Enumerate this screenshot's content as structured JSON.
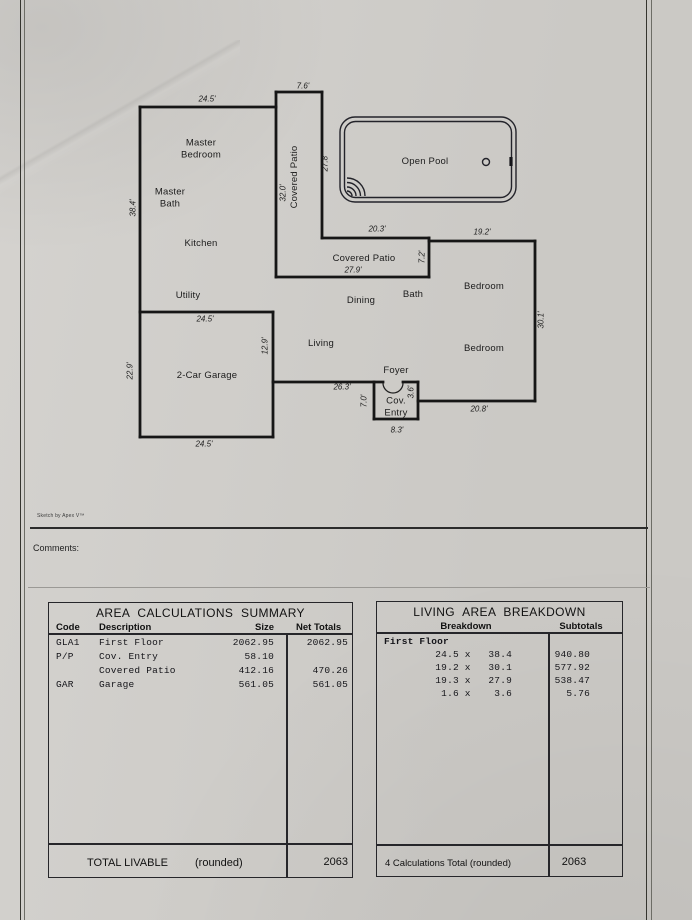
{
  "page": {
    "paper_color": "#d2d0cc",
    "ink_color": "#1c1c1c"
  },
  "footer": {
    "sketch_credit": "Sketch by Apex V™",
    "comments_label": "Comments:"
  },
  "plan": {
    "rooms": [
      {
        "id": "master-bedroom",
        "text": "Master\nBedroom"
      },
      {
        "id": "master-bath",
        "text": "Master\nBath"
      },
      {
        "id": "kitchen",
        "text": "Kitchen"
      },
      {
        "id": "utility",
        "text": "Utility"
      },
      {
        "id": "garage",
        "text": "2-Car Garage"
      },
      {
        "id": "covered-patio-vertical",
        "text": "Covered Patio"
      },
      {
        "id": "open-pool",
        "text": "Open Pool"
      },
      {
        "id": "covered-patio",
        "text": "Covered Patio"
      },
      {
        "id": "dining",
        "text": "Dining"
      },
      {
        "id": "bath",
        "text": "Bath"
      },
      {
        "id": "bedroom-north",
        "text": "Bedroom"
      },
      {
        "id": "bedroom-south",
        "text": "Bedroom"
      },
      {
        "id": "living",
        "text": "Living"
      },
      {
        "id": "foyer",
        "text": "Foyer"
      },
      {
        "id": "cov-entry",
        "text": "Cov.\nEntry"
      }
    ],
    "dimensions": [
      {
        "text": "24.5'"
      },
      {
        "text": "7.6'"
      },
      {
        "text": "38.4'"
      },
      {
        "text": "32.0'"
      },
      {
        "text": "27.8'"
      },
      {
        "text": "20.3'"
      },
      {
        "text": "19.2'"
      },
      {
        "text": "27.9'"
      },
      {
        "text": "7.2'"
      },
      {
        "text": "30.1'"
      },
      {
        "text": "22.9'"
      },
      {
        "text": "24.5'"
      },
      {
        "text": "12.9'"
      },
      {
        "text": "24.5'"
      },
      {
        "text": "26.3'"
      },
      {
        "text": "7.0'"
      },
      {
        "text": "3.6'"
      },
      {
        "text": "8.3'"
      },
      {
        "text": "20.8'"
      }
    ]
  },
  "area_summary": {
    "title": "AREA CALCULATIONS SUMMARY",
    "headers": {
      "code": "Code",
      "description": "Description",
      "size": "Size",
      "net": "Net Totals"
    },
    "rows": [
      {
        "code": "GLA1",
        "description": "First Floor",
        "size": "2062.95",
        "net": "2062.95"
      },
      {
        "code": "P/P",
        "description": "Cov. Entry",
        "size": "58.10",
        "net": ""
      },
      {
        "code": "",
        "description": "Covered Patio",
        "size": "412.16",
        "net": "470.26"
      },
      {
        "code": "GAR",
        "description": "Garage",
        "size": "561.05",
        "net": "561.05"
      }
    ],
    "total": {
      "label": "TOTAL LIVABLE",
      "note": "(rounded)",
      "value": "2063"
    }
  },
  "living_breakdown": {
    "title": "LIVING AREA BREAKDOWN",
    "headers": {
      "breakdown": "Breakdown",
      "subtotals": "Subtotals"
    },
    "section_label": "First Floor",
    "rows": [
      {
        "breakdown": "24.5 x   38.4",
        "subtotal": "940.80"
      },
      {
        "breakdown": "19.2 x   30.1",
        "subtotal": "577.92"
      },
      {
        "breakdown": "19.3 x   27.9",
        "subtotal": "538.47"
      },
      {
        "breakdown": " 1.6 x    3.6",
        "subtotal": "5.76"
      }
    ],
    "total": {
      "label": "4 Calculations Total (rounded)",
      "value": "2063"
    }
  }
}
